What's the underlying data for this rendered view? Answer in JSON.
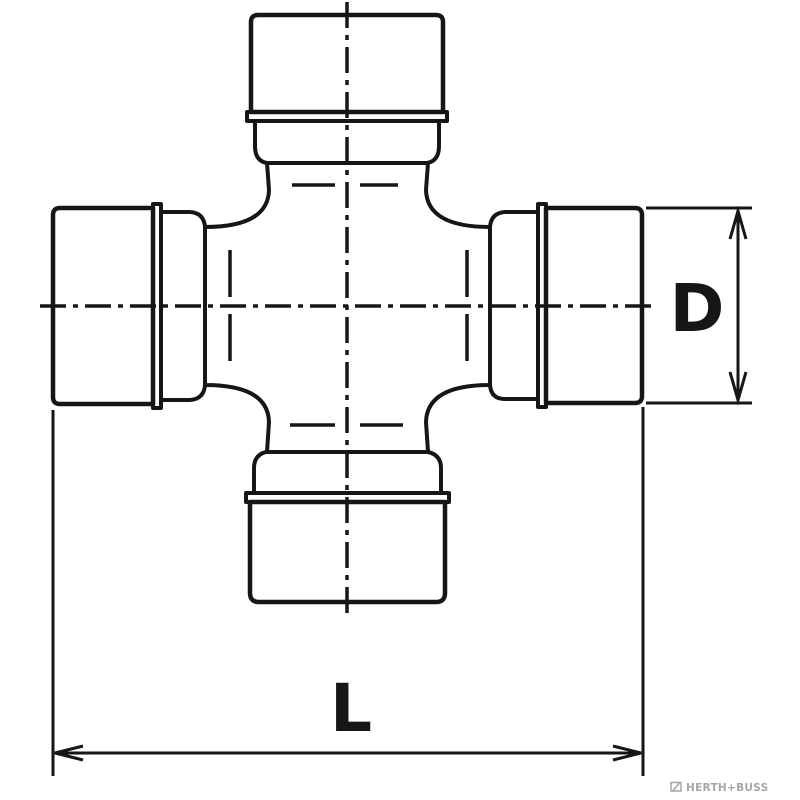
{
  "page": {
    "background": "#ffffff"
  },
  "drawing": {
    "kind": "technical-line-drawing",
    "subject": "universal joint cross (spider) with four bearing cups, front view",
    "line_color": "#161616",
    "dimensions": {
      "d_label": "D",
      "l_label": "L"
    },
    "watermark": {
      "text": "HERTH+BUSS",
      "color": "#a6a6a6"
    }
  }
}
